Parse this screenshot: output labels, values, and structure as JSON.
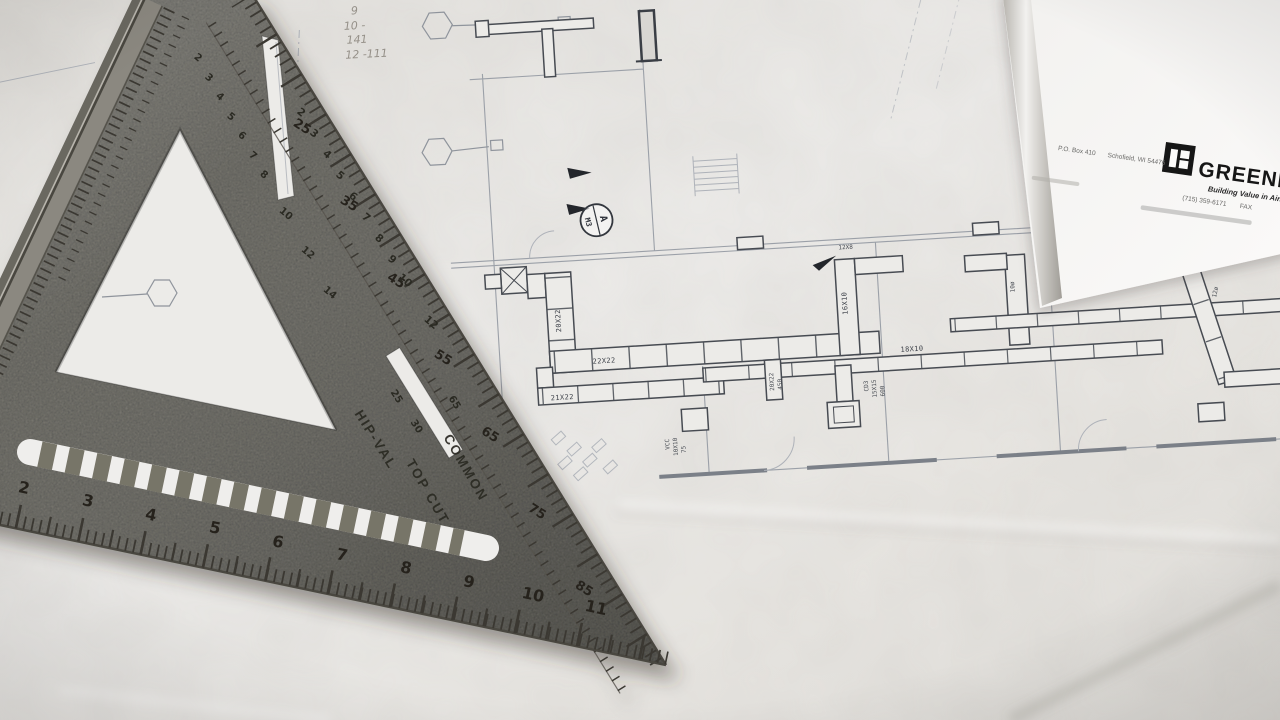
{
  "blueprint": {
    "handwritten_notes": [
      "9",
      "10 -",
      "141",
      "12 -111"
    ],
    "duct_labels": {
      "trunk": "20X22",
      "run_a": "22X22",
      "run_b": "21X22",
      "run_c": "18X10",
      "branch": "16X10"
    },
    "tiny_labels": {
      "cd": "CD3",
      "cd_size": "15X15",
      "cd_cfm": "600",
      "vcc": "VCC",
      "vcc_size": "10X10",
      "vcc_cfm": "75",
      "drop": "20X22",
      "drop_cfm": "450",
      "dia": "12ø",
      "dia2": "10ø",
      "branch2": "12X8"
    },
    "section_marker": {
      "top": "A",
      "bottom": "M3"
    }
  },
  "document": {
    "brand": "GREENHECK",
    "tagline": "Building Value in Air.",
    "po_box": "P.O. Box 410",
    "city": "Schofield, WI 54476",
    "phone": "(715) 359-6171",
    "fax": "FAX"
  },
  "square": {
    "engraving_hip": "HIP-VAL",
    "engraving_top_cut": "TOP CUT",
    "engraving_common": "COMMON",
    "bottom_numbers": [
      "2",
      "3",
      "4",
      "5",
      "6",
      "7",
      "8",
      "9",
      "10",
      "11"
    ],
    "degree_numbers": [
      "25",
      "35",
      "45",
      "55",
      "65",
      "75",
      "85"
    ],
    "rafter_numbers": [
      "2",
      "3",
      "4",
      "5",
      "6",
      "7",
      "8",
      "9",
      "10",
      "12"
    ],
    "inner_numbers": [
      "2",
      "3",
      "4",
      "5",
      "6",
      "7",
      "8",
      "10",
      "12",
      "14"
    ],
    "pivot_numbers": [
      "25",
      "30",
      "65"
    ]
  },
  "colors": {
    "metal": "#7e7b73",
    "paper": "#edecea",
    "blueprint_ink": "#454952",
    "engraving": "#26241e",
    "logo_black": "#141414"
  }
}
